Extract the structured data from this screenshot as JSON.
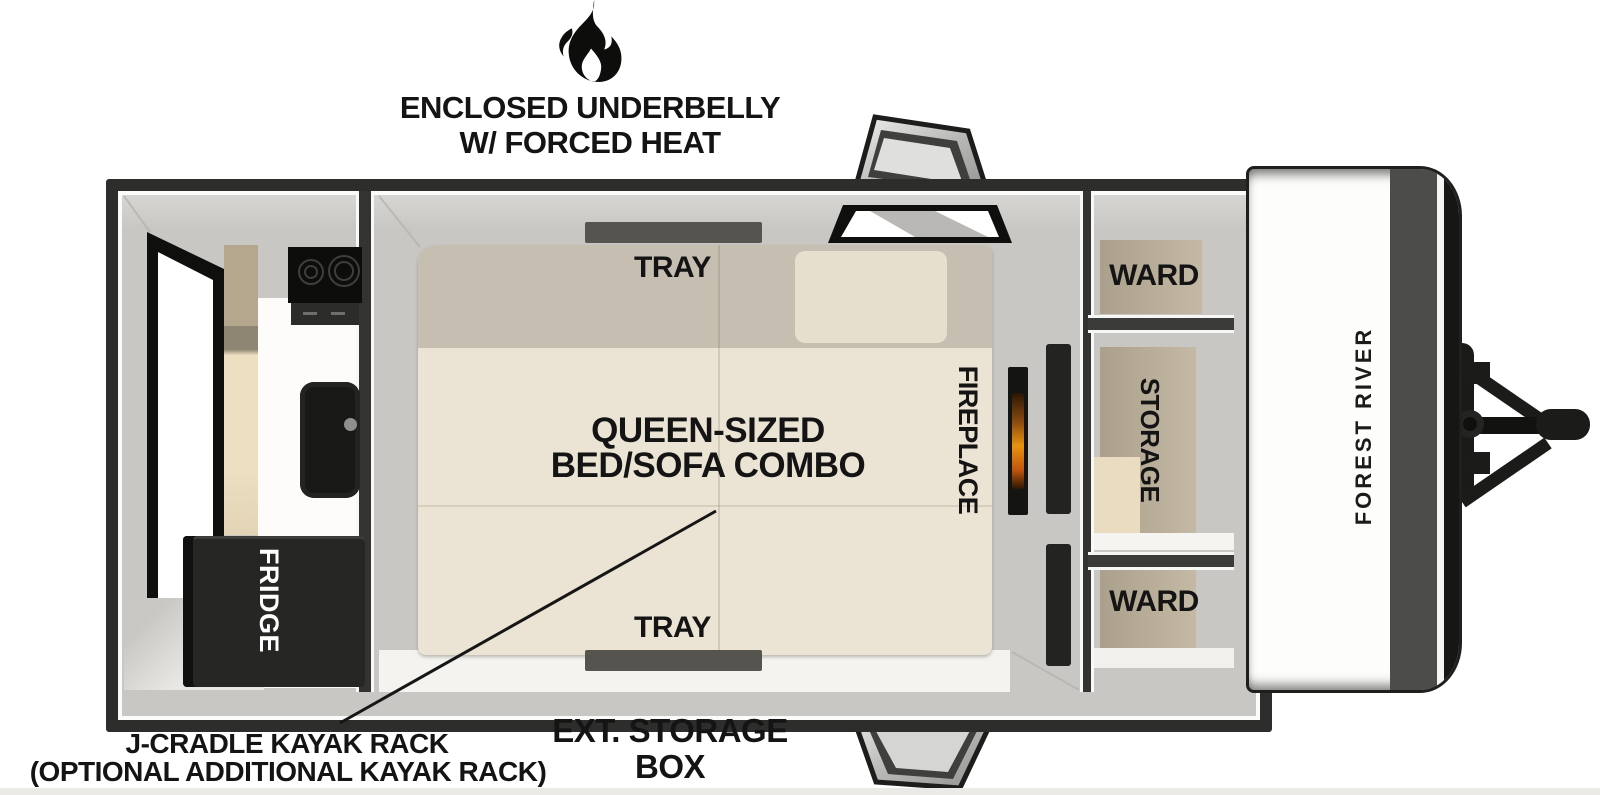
{
  "header": {
    "icon": "flame-icon",
    "line1": "ENCLOSED UNDERBELLY",
    "line2": "W/ FORCED HEAT"
  },
  "floorplan": {
    "brand": "FOREST RIVER",
    "kitchen": {
      "fridge": "FRIDGE"
    },
    "bedroom": {
      "tray_top": "TRAY",
      "tray_bottom": "TRAY",
      "bed_line1": "QUEEN-SIZED",
      "bed_line2": "BED/SOFA COMBO",
      "fireplace": "FIREPLACE"
    },
    "storage_wall": {
      "ward_top": "WARD",
      "storage": "STORAGE",
      "ward_bottom": "WARD"
    }
  },
  "annotations": {
    "kayak_line1": "J-CRADLE KAYAK RACK",
    "kayak_line2": "(OPTIONAL ADDITIONAL KAYAK RACK)",
    "ext_line1": "EXT. STORAGE",
    "ext_line2": "BOX"
  },
  "colors": {
    "outline": "#2d2d2b",
    "wall": "#c8c7c3",
    "floor": "#f4f3ef",
    "bed": "#ebe4d4",
    "bed_head": "#c6bfb1",
    "cabinet_tan": "#b3a892",
    "appliance_black": "#161614",
    "flame_accent": "#e8920f"
  }
}
